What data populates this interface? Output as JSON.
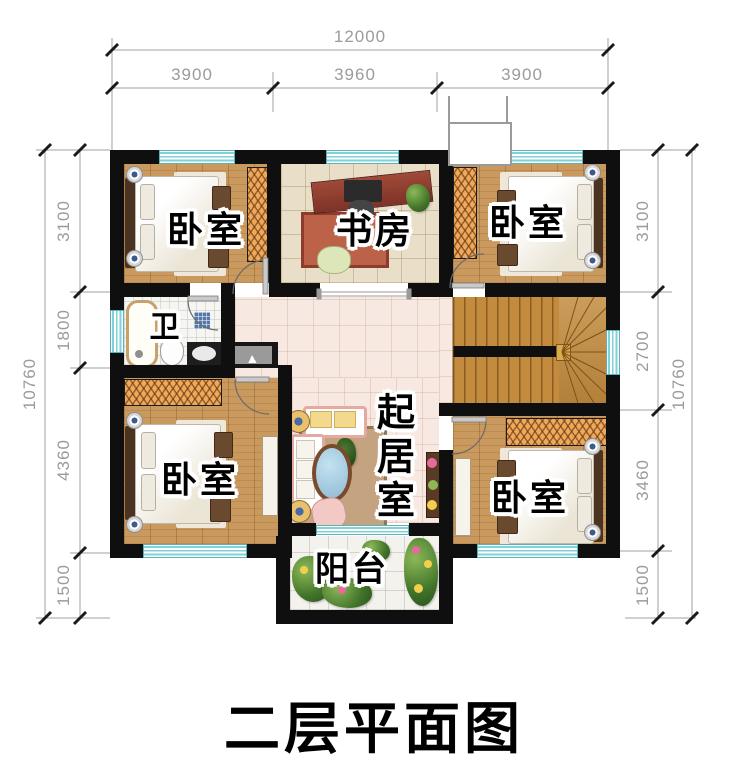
{
  "title": "二层平面图",
  "rooms": {
    "bedroom_top_left": {
      "label": "卧室"
    },
    "study": {
      "label": "书房"
    },
    "bedroom_top_right": {
      "label": "卧室"
    },
    "bathroom": {
      "label": "卫"
    },
    "living_room": {
      "label": "起居室"
    },
    "bedroom_bottom_left": {
      "label": "卧室"
    },
    "bedroom_bottom_right": {
      "label": "卧室"
    },
    "balcony": {
      "label": "阳台"
    }
  },
  "dimensions": {
    "top": {
      "total": "12000",
      "segments": [
        "3900",
        "3960",
        "3900"
      ]
    },
    "left": {
      "total": "10760",
      "segments": [
        "3100",
        "1800",
        "4360",
        "1500"
      ]
    },
    "right": {
      "total": "10760",
      "segments": [
        "3100",
        "2700",
        "3460",
        "1500"
      ]
    }
  },
  "colors": {
    "wall": "#0f0f0f",
    "window_glass": "#7fd2d6",
    "wood_floor": "#c9995e",
    "stair_wood": "#c28b3e",
    "tile_pink": "#f7e9e1",
    "tile_beige": "#e9dfc9",
    "wardrobe_hatch": "#efa95c",
    "dimension_text": "#9b9b9b"
  }
}
